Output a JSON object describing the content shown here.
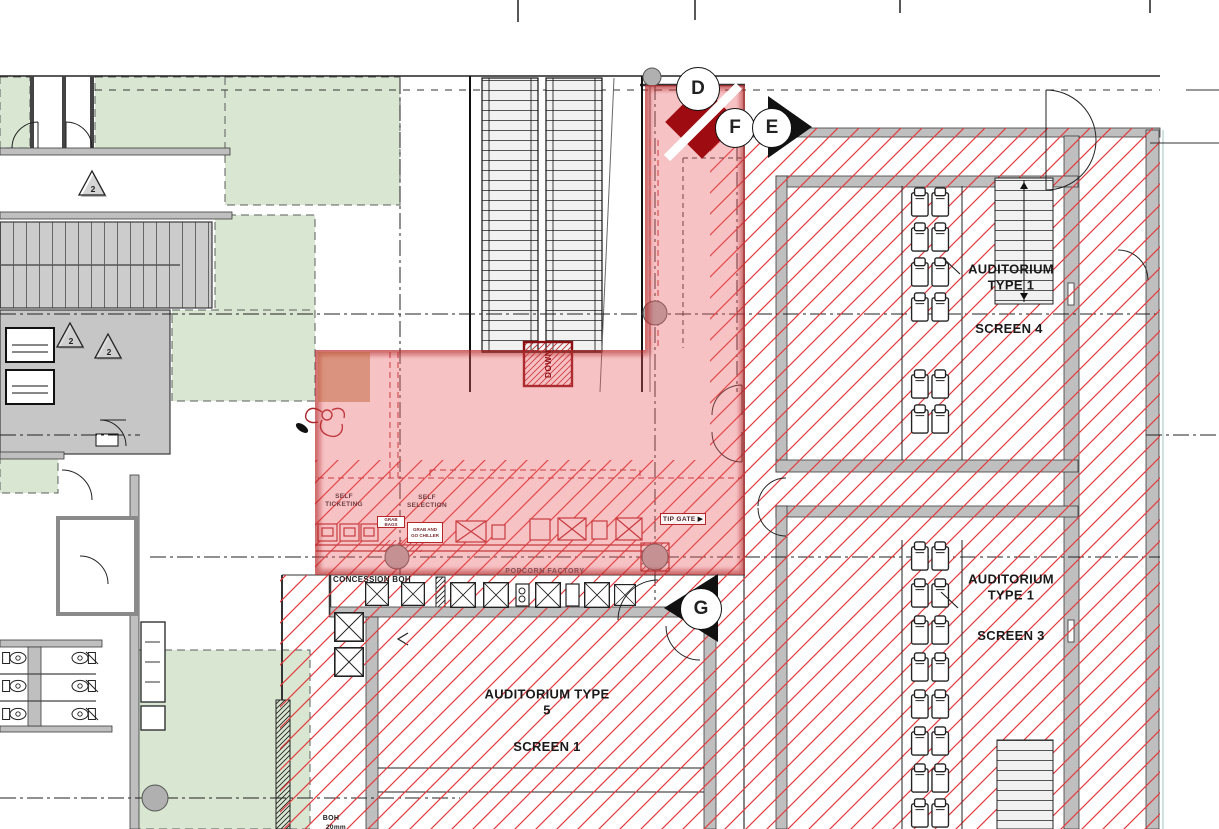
{
  "drawing": {
    "auditorium_screen4": {
      "name": "AUDITORIUM TYPE 1",
      "screen": "SCREEN 4"
    },
    "auditorium_screen3": {
      "name": "AUDITORIUM TYPE 1",
      "screen": "SCREEN 3"
    },
    "auditorium_screen1": {
      "name": "AUDITORIUM TYPE 5",
      "screen": "SCREEN 1"
    },
    "concession": {
      "self_ticketing": "SELF TICKETING",
      "self_selection": "SELF SELECTION",
      "grab_bags": "GRAB BAGS",
      "grab_and_go_chiller": "GRAB AND GO CHILLER",
      "tip_gate": "TIP GATE",
      "popcorn_factory": "POPCORN FACTORY",
      "concession_boh": "CONCESSION BOH"
    },
    "misc": {
      "down": "DOWN",
      "boh": "BOH",
      "boh_note": "20mm",
      "revision_number": "2"
    },
    "grid_markers": {
      "d": "D",
      "e": "E",
      "f": "F",
      "g": "G"
    },
    "icons": {
      "tip_gate_arrow": "▶"
    },
    "colors": {
      "hatch_red": "#e13c3f",
      "overlay_pink": "rgba(231,95,99,0.38)",
      "overlay_edge": "rgba(168,24,28,0.5)",
      "zone_green": "#d9e7d2",
      "wall_gray": "#bfbfbf",
      "marker_dark_red": "#9e0b10",
      "highlight_tan": "rgba(190,100,55,0.5)"
    }
  }
}
